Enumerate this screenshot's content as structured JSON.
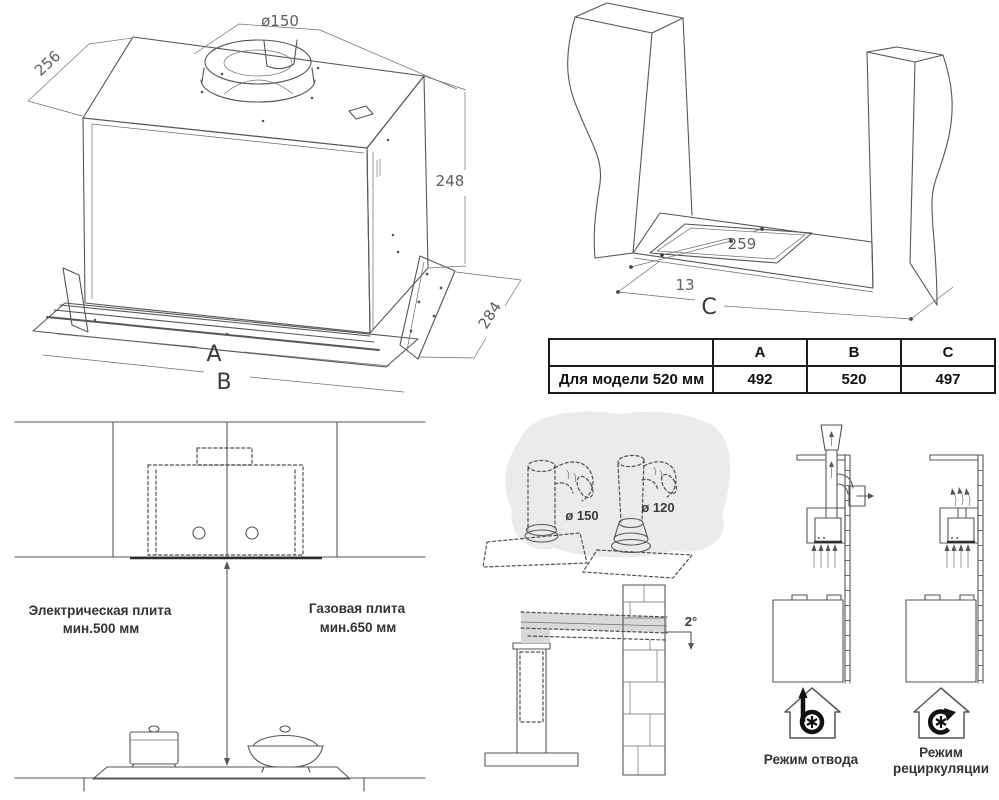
{
  "hood_drawing": {
    "dim_diameter": "ø150",
    "dim_depth_top": "256",
    "dim_height": "248",
    "dim_depth_bottom": "284",
    "dim_width_a": "A",
    "dim_width_b": "B"
  },
  "cutout_drawing": {
    "dim_cutout_depth": "259",
    "dim_edge_offset": "13",
    "dim_width_c": "C"
  },
  "size_table": {
    "col_a": "A",
    "col_b": "B",
    "col_c": "C",
    "row_label": "Для модели 520 мм",
    "val_a": "492",
    "val_b": "520",
    "val_c": "497"
  },
  "clearance_diagram": {
    "electric_line1": "Электрическая плита",
    "electric_line2": "мин.500 мм",
    "gas_line1": "Газовая плита",
    "gas_line2": "мин.650 мм"
  },
  "duct_diagram": {
    "dim_duct_large": "ø 150",
    "dim_duct_small": "ø 120",
    "slope_angle": "2°"
  },
  "modes": {
    "exhaust_label": "Режим отвода",
    "recirc_label_line1": "Режим",
    "recirc_label_line2": "рециркуляции"
  },
  "colors": {
    "line": "#565656",
    "text": "#333333",
    "table_border": "#1c1c1c",
    "shade": "#ebebeb"
  }
}
